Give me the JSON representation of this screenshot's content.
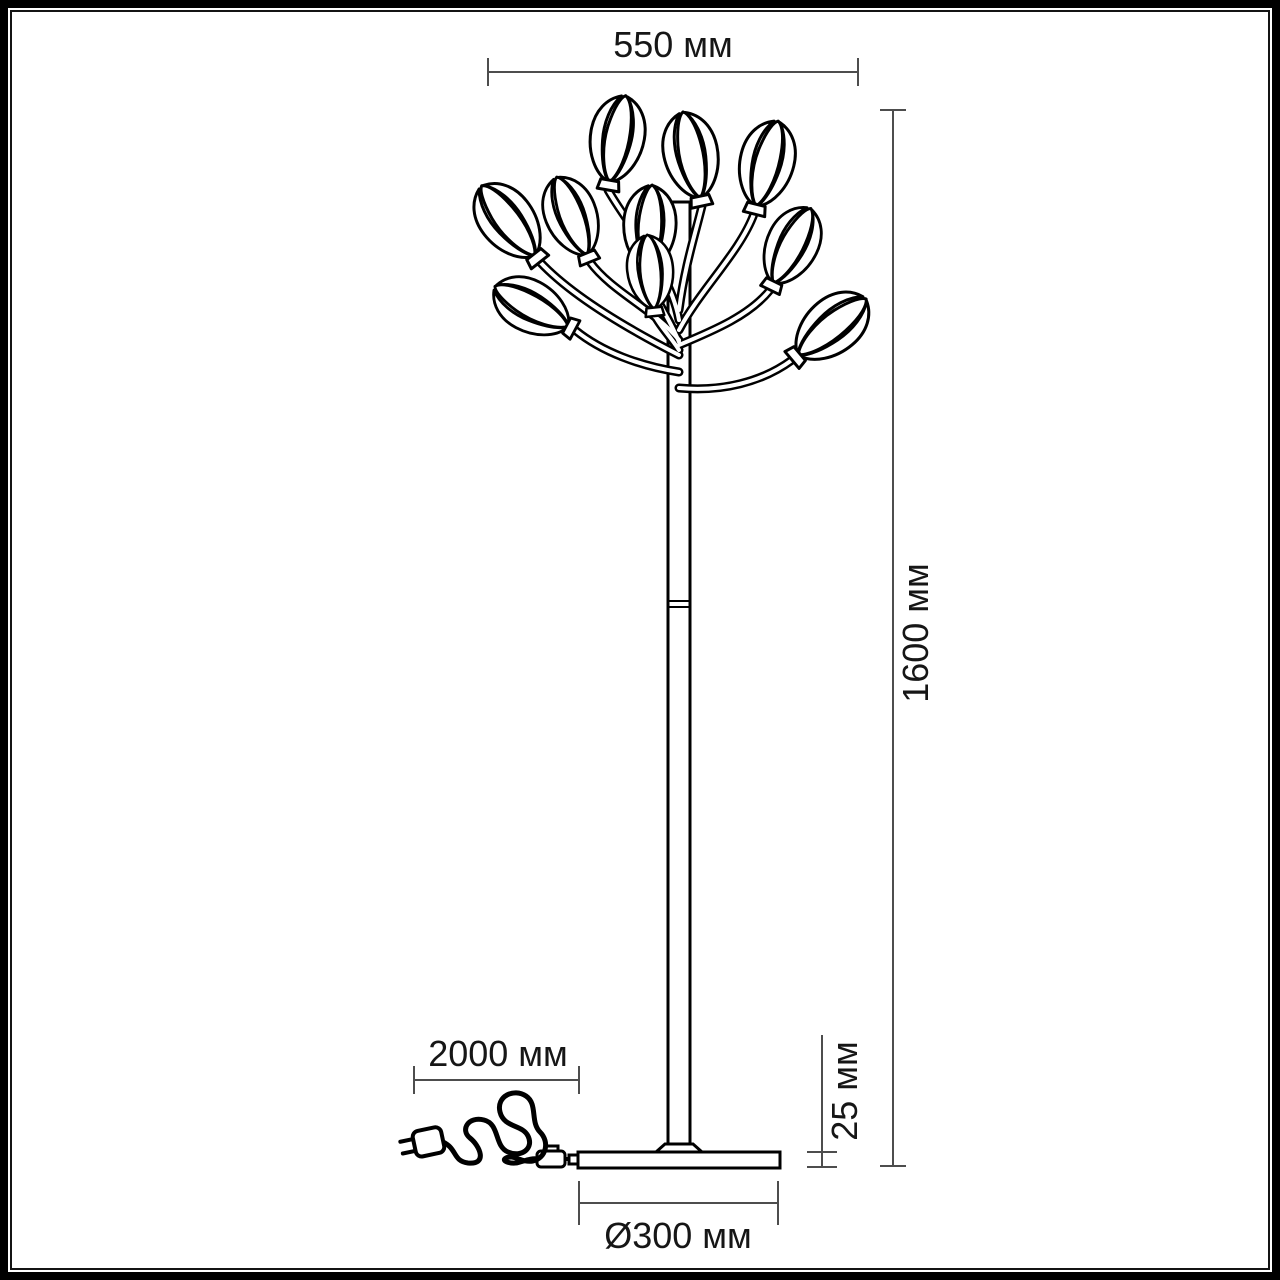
{
  "diagram": {
    "title": "Floor lamp dimension drawing",
    "dimensions": {
      "top_width": "550 мм",
      "height": "1600 мм",
      "cord_length": "2000 мм",
      "base_thickness": "25 мм",
      "base_diameter": "Ø300 мм"
    },
    "colors": {
      "artwork_line": "#000000",
      "dimension_line": "#4d4d4d",
      "label_text": "#161616",
      "background": "#ffffff",
      "frame_outer": "#000000",
      "frame_inner": "#141414"
    }
  }
}
